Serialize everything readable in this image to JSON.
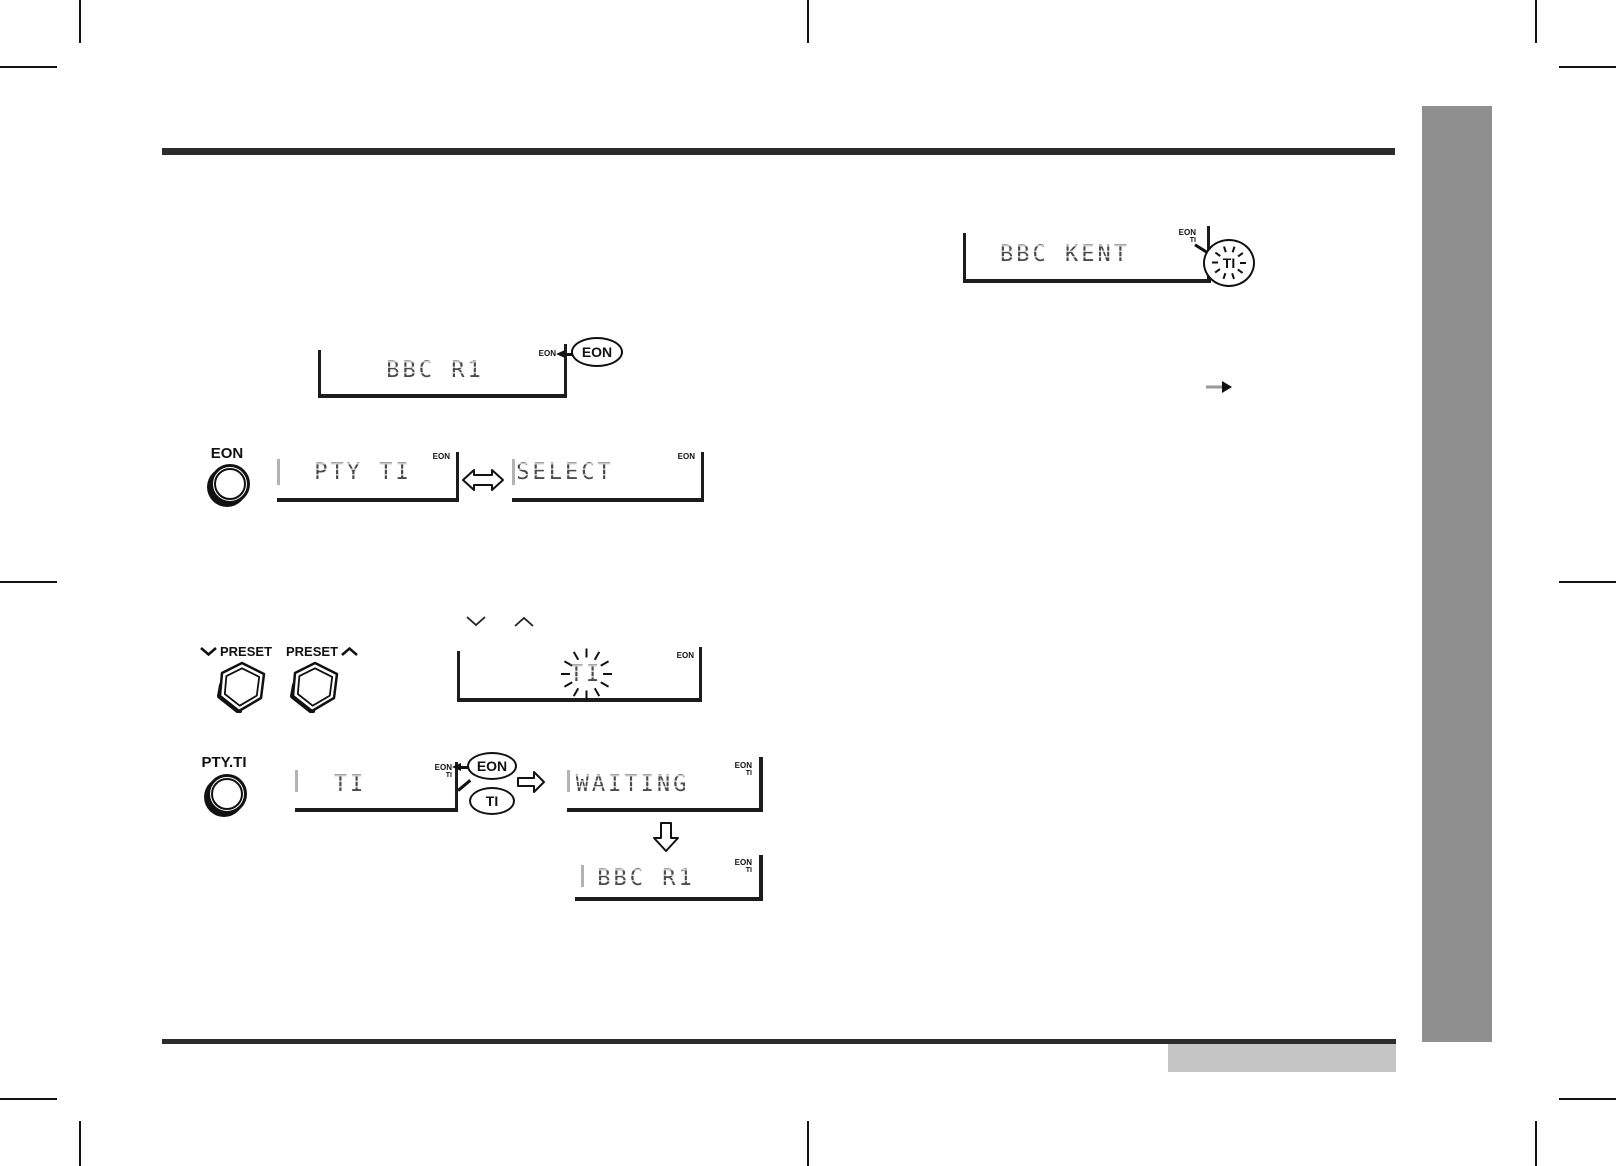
{
  "page": {
    "buttons": {
      "eon": "EON",
      "preset_down": "PRESET",
      "preset_up": "PRESET",
      "pty_ti": "PTY.TI"
    },
    "displays": {
      "tuned": {
        "text": "BBC KENT",
        "ind_eon": "EON",
        "ind_ti": "TI"
      },
      "eon_detect": {
        "text": "BBC R1",
        "ind_eon": "EON"
      },
      "mode": {
        "text": "PTY TI",
        "ind_eon": "EON"
      },
      "select": {
        "text": "SELECT",
        "ind_eon": "EON"
      },
      "ti_blink": {
        "text": "TI",
        "ind_eon": "EON"
      },
      "ti_set": {
        "text": "TI",
        "ind_eon": "EON",
        "ind_ti": "TI"
      },
      "waiting": {
        "text": "WAITING",
        "ind_eon": "EON",
        "ind_ti": "TI"
      },
      "result": {
        "text": "BBC R1",
        "ind_eon": "EON",
        "ind_ti": "TI"
      }
    },
    "callouts": {
      "ti_blinking": "TI",
      "eon_lit": "EON",
      "eon_ind": "EON",
      "ti_ind": "TI"
    },
    "icons": {
      "chevron_down": "∨",
      "chevron_up": "∧",
      "left_right_block_arrow": "⇔",
      "right_block_arrow": "⇨",
      "down_block_arrow": "⇩",
      "left_arrowhead": "◄",
      "right_arrow": "→"
    },
    "colors": {
      "rule": "#2b2b2b",
      "sidebar": "#8f8f8f",
      "footer_box": "#c5c5c5",
      "lcd_text": "#4a4a4a"
    }
  }
}
